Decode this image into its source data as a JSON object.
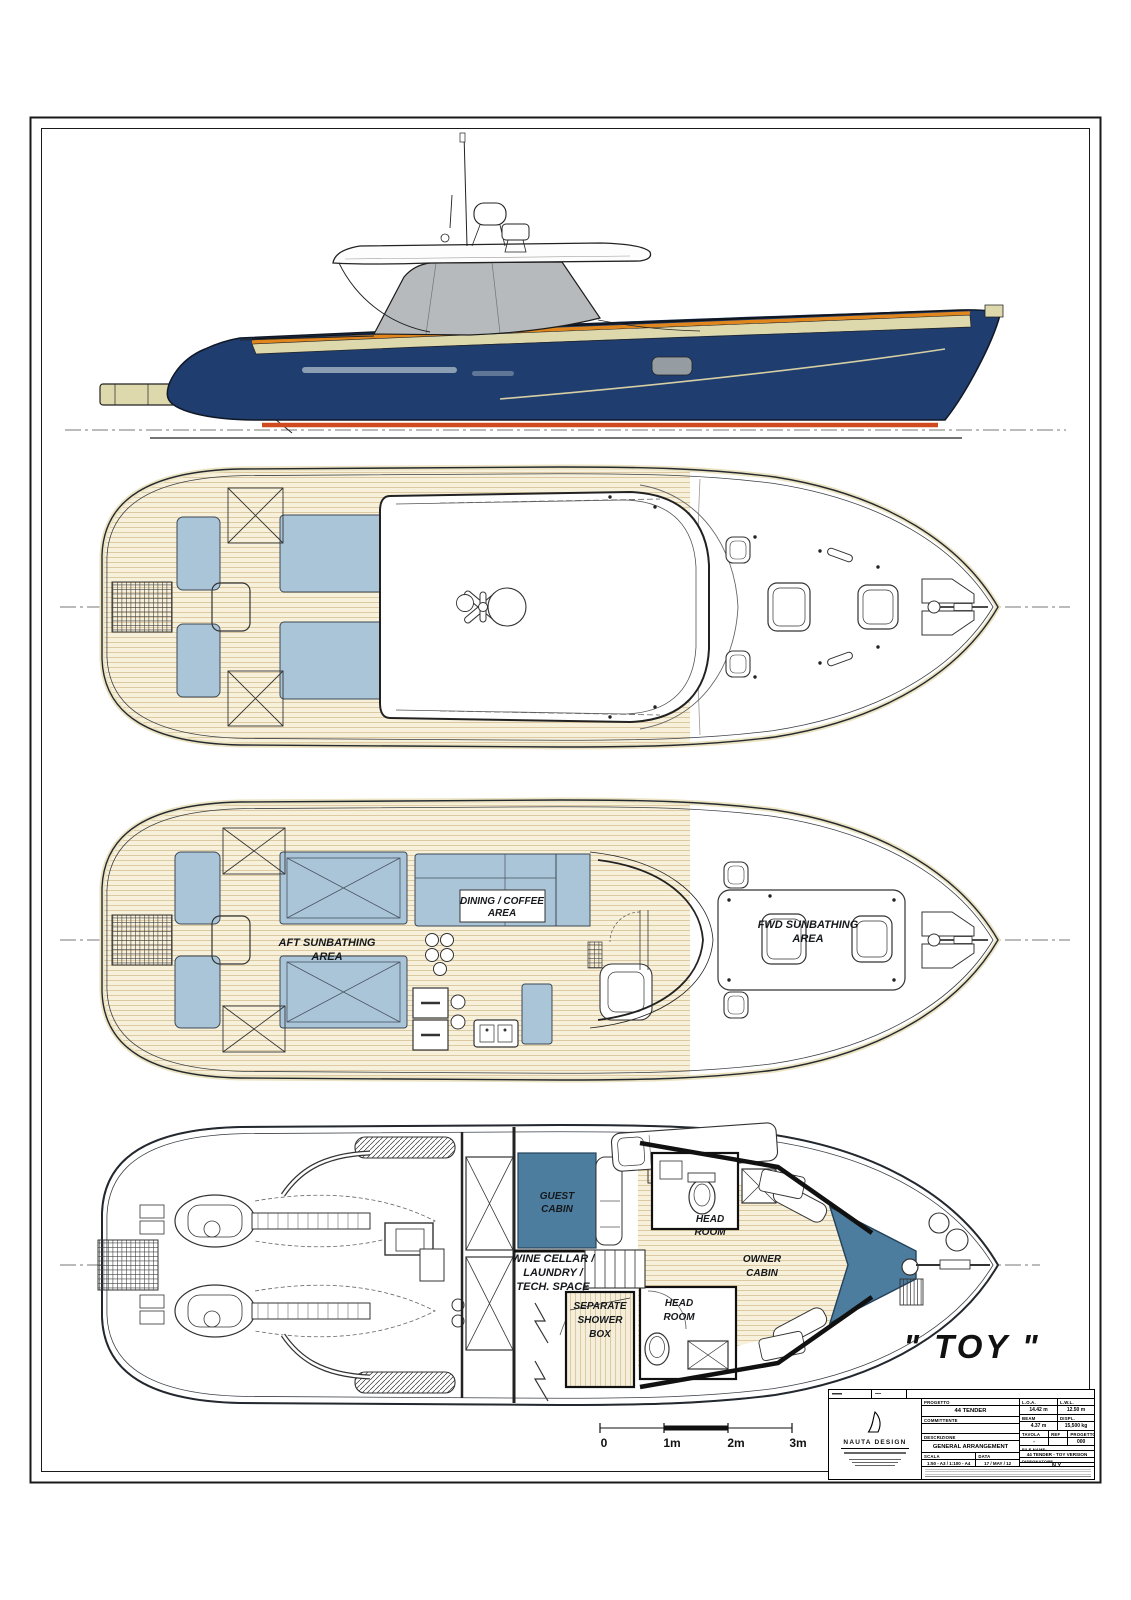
{
  "drawing": {
    "boat_name": "\" TOY \"",
    "colors": {
      "hull_navy": "#1f3d6e",
      "sheer_orange": "#e0861c",
      "boot_red": "#cf4a1e",
      "cream": "#ded8ad",
      "teak": "#f7f0db",
      "pad_blue": "#abc5d8",
      "bed_blue": "#4d7d9e",
      "glass_gray": "#b6babc"
    }
  },
  "labels": {
    "aft_sun_1": "AFT SUNBATHING",
    "aft_sun_2": "AREA",
    "dining_1": "DINING / COFFEE",
    "dining_2": "AREA",
    "fwd_sun_1": "FWD SUNBATHING",
    "fwd_sun_2": "AREA",
    "guest_1": "GUEST",
    "guest_2": "CABIN",
    "head_fwd_1": "HEAD",
    "head_fwd_2": "ROOM",
    "head_aft_1": "HEAD",
    "head_aft_2": "ROOM",
    "owner_1": "OWNER",
    "owner_2": "CABIN",
    "wine_1": "WINE CELLAR /",
    "wine_2": "LAUNDRY /",
    "wine_3": "TECH. SPACE",
    "shower_1": "SEPARATE",
    "shower_2": "SHOWER",
    "shower_3": "BOX",
    "boat_name": "\" TOY \""
  },
  "scale_bar": {
    "t0": "0",
    "t1": "1m",
    "t2": "2m",
    "t3": "3m"
  },
  "title_block": {
    "logo_text": "NAUTA DESIGN",
    "progetto_label": "PROGETTO",
    "progetto_value": "44 TENDER",
    "committente_label": "COMMITTENTE",
    "committente_value": "",
    "descrizione_label": "DESCRIZIONE",
    "descrizione_value": "GENERAL ARRANGEMENT",
    "scala_label": "SCALA",
    "scala_value": "1:50 - A3 / 1:100 - A4",
    "data_label": "DATA",
    "data_value": "17 / MAY / 12",
    "loa_label": "L.O.A.",
    "loa_value": "14.42 m",
    "lwl_label": "L.W.L.",
    "lwl_value": "12.50 m",
    "beam_label": "BEAM",
    "beam_value": "4.37 m",
    "displ_label": "DISPL.",
    "displ_value": "15,500 kg",
    "tavola_label": "TAVOLA",
    "ref_label": "REF",
    "prog_label": "PROGETTO",
    "tavola_value": "-",
    "ref_value": "000",
    "file_label": "FILE NAME:",
    "file_value": "44 TENDER - TOY VERSION",
    "disegnatore_label": "DISEGNATORE",
    "disegnatore_value": "N.Y."
  }
}
